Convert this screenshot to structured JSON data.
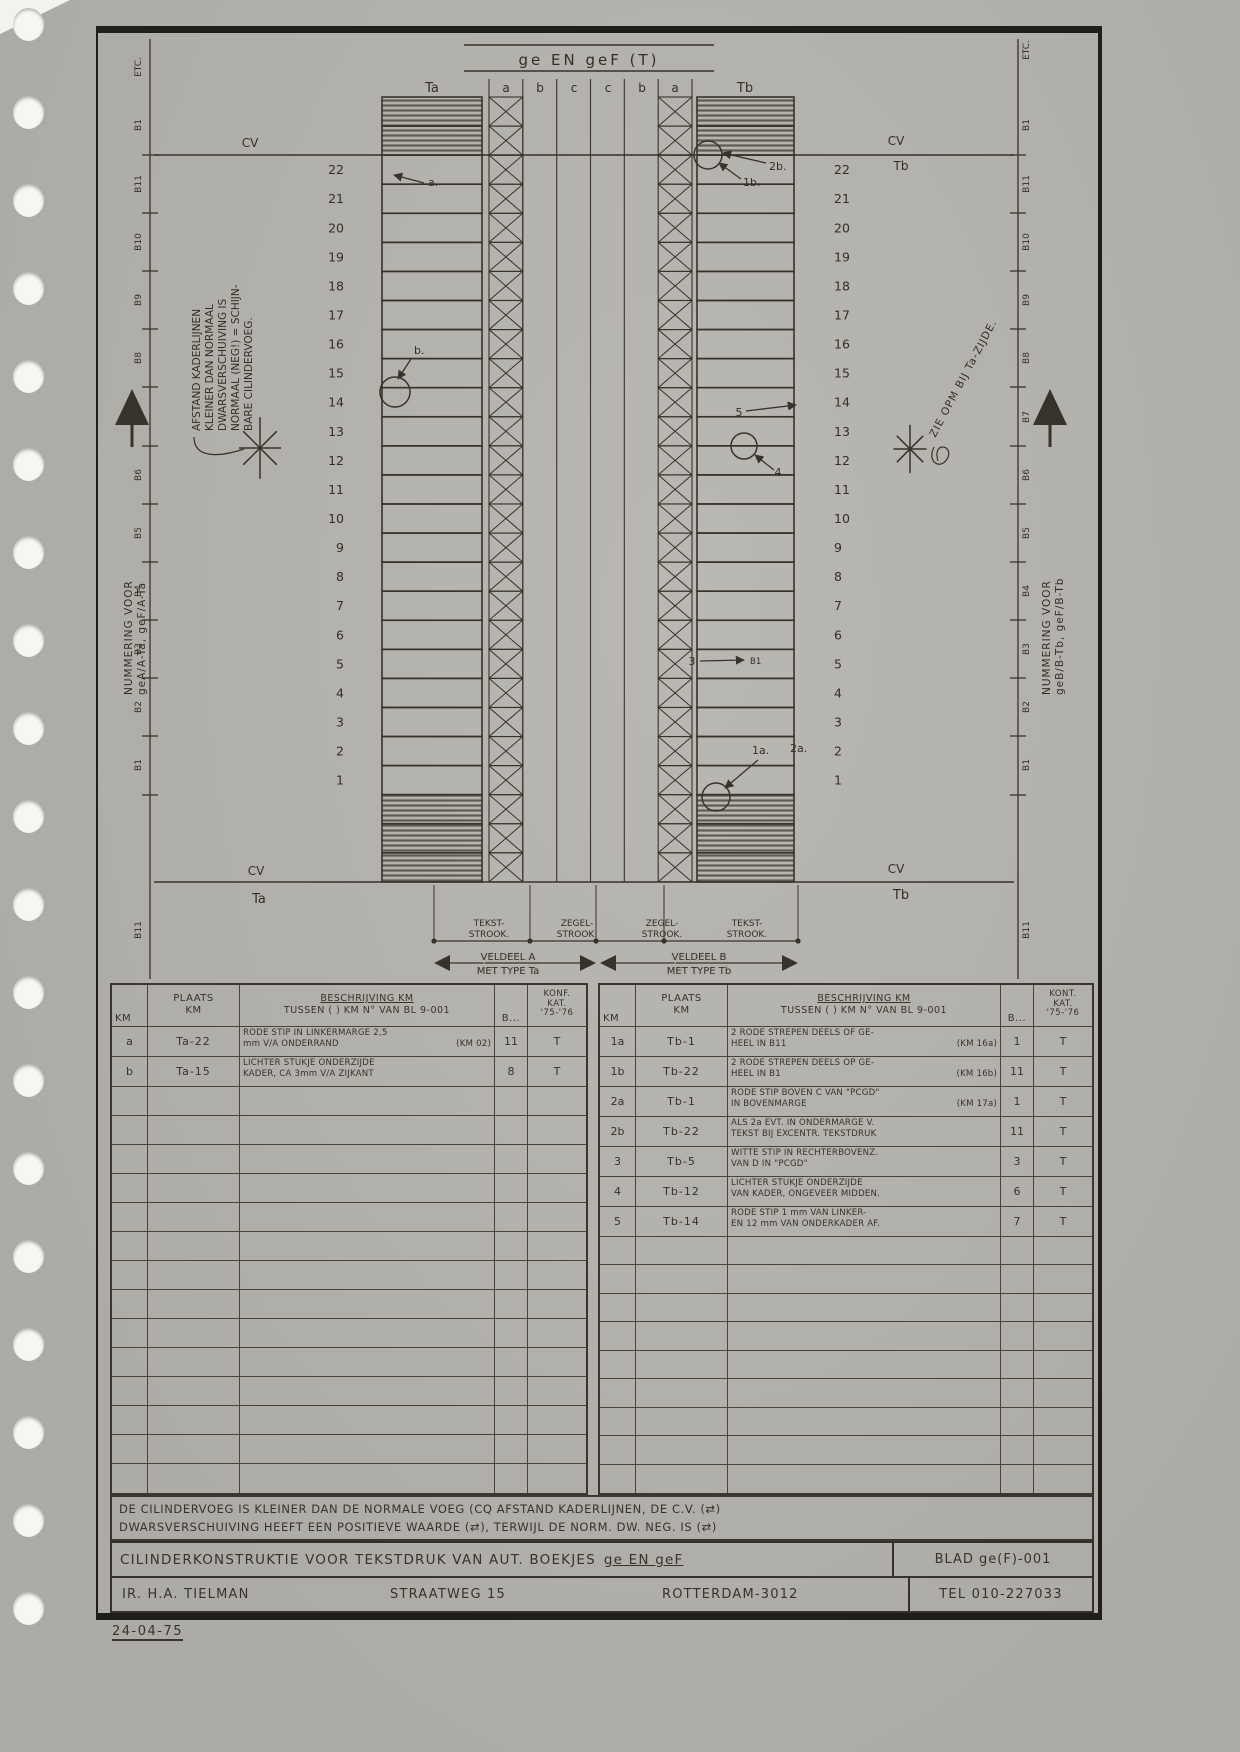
{
  "diagram": {
    "title": "ge EN geF (T)",
    "column_headers": [
      "Ta",
      "a",
      "b",
      "c",
      "c",
      "b",
      "a",
      "Tb"
    ],
    "row_numbers": [
      "22",
      "21",
      "20",
      "19",
      "18",
      "17",
      "16",
      "15",
      "14",
      "13",
      "12",
      "11",
      "10",
      "9",
      "8",
      "7",
      "6",
      "5",
      "4",
      "3",
      "2",
      "1"
    ],
    "left_ruler": [
      "ETC.",
      "B1",
      "B11",
      "B10",
      "B9",
      "B8",
      "B7",
      "B6",
      "B5",
      "B4",
      "B3",
      "B2",
      "B1",
      "B11"
    ],
    "right_ruler": [
      "ETC.",
      "B1",
      "B11",
      "B10",
      "B9",
      "B8",
      "B7",
      "B6",
      "B5",
      "B4",
      "B3",
      "B2",
      "B1",
      "B11"
    ],
    "cv_label": "CV",
    "ta_label": "Ta",
    "tb_label": "Tb",
    "left_note_lines": [
      "AFSTAND KADERLIJNEN",
      "KLEINER DAN NORMAAL",
      "DWARSVERSCHUIVING IS",
      "NORMAAL (NEG!) = SCHIJN-",
      "BARE CILINDERVOEG."
    ],
    "left_numbering_lines": [
      "NUMMERING VOOR",
      "geA/A-Ta, geF/A-Ta"
    ],
    "right_numbering_lines": [
      "NUMMERING VOOR",
      "geB/B-Tb, geF/B-Tb"
    ],
    "right_note": "ZIE OPM BIJ Ta-ZIJDE.",
    "annotations": {
      "a": "a.",
      "b": "b.",
      "b1": "1b.",
      "b2": "2b.",
      "n5": "5",
      "n4": "4",
      "n3": "3",
      "t3": "B1",
      "a1": "1a.",
      "a2": "2a."
    },
    "strip_labels": [
      [
        "TEKST-",
        "STROOK."
      ],
      [
        "ZEGEL-",
        "STROOK."
      ],
      [
        "ZEGEL-",
        "STROOK."
      ],
      [
        "TEKST-",
        "STROOK."
      ]
    ],
    "veldeel_a": [
      "VELDEEL A",
      "MET TYPE Ta"
    ],
    "veldeel_b": [
      "VELDEEL B",
      "MET TYPE Tb"
    ]
  },
  "tables": {
    "left": {
      "headers": {
        "km": "KM",
        "plaats": "PLAATS KM",
        "besch1": "BESCHRIJVING KM",
        "besch2": "TUSSEN ( ) KM N° VAN BL 9-001",
        "b": "B...",
        "kat": "KONF. KAT. '75-'76"
      },
      "rows": [
        {
          "km": "a",
          "plaats": "Ta-22",
          "l1": "RODE STIP IN LINKERMARGE 2,5",
          "l2": "mm V/A ONDERRAND",
          "ref": "(KM 02)",
          "b": "11",
          "kat": "T"
        },
        {
          "km": "b",
          "plaats": "Ta-15",
          "l1": "LICHTER STUKJE ONDERZIJDE",
          "l2": "KADER, CA 3mm V/A ZIJKANT",
          "ref": "",
          "b": "8",
          "kat": "T"
        }
      ],
      "empty_rows": 14
    },
    "right": {
      "headers": {
        "km": "KM",
        "plaats": "PLAATS KM",
        "besch1": "BESCHRIJVING KM",
        "besch2": "TUSSEN ( ) KM N° VAN BL 9-001",
        "b": "B...",
        "kat": "KONT. KAT. '75-'76"
      },
      "rows": [
        {
          "km": "1a",
          "plaats": "Tb-1",
          "l1": "2 RODE STREPEN DEELS OF GE-",
          "l2": "HEEL IN B11",
          "ref": "(KM 16a)",
          "b": "1",
          "kat": "T"
        },
        {
          "km": "1b",
          "plaats": "Tb-22",
          "l1": "2 RODE STREPEN DEELS OP GE-",
          "l2": "HEEL IN B1",
          "ref": "(KM 16b)",
          "b": "11",
          "kat": "T"
        },
        {
          "km": "2a",
          "plaats": "Tb-1",
          "l1": "RODE STIP BOVEN C VAN \"PCGD\"",
          "l2": "IN BOVENMARGE",
          "ref": "(KM 17a)",
          "b": "1",
          "kat": "T"
        },
        {
          "km": "2b",
          "plaats": "Tb-22",
          "l1": "ALS 2a EVT. IN ONDERMARGE V.",
          "l2": "TEKST BIJ EXCENTR. TEKSTDRUK",
          "ref": "",
          "b": "11",
          "kat": "T"
        },
        {
          "km": "3",
          "plaats": "Tb-5",
          "l1": "WITTE STIP IN RECHTERBOVENZ.",
          "l2": "VAN D IN \"PCGD\"",
          "ref": "",
          "b": "3",
          "kat": "T"
        },
        {
          "km": "4",
          "plaats": "Tb-12",
          "l1": "LICHTER STUKJE ONDERZIJDE",
          "l2": "VAN KADER, ONGEVEER MIDDEN.",
          "ref": "",
          "b": "6",
          "kat": "T"
        },
        {
          "km": "5",
          "plaats": "Tb-14",
          "l1": "RODE STIP 1 mm VAN LINKER-",
          "l2": "EN 12 mm VAN ONDERKADER AF.",
          "ref": "",
          "b": "7",
          "kat": "T"
        }
      ],
      "empty_rows": 9
    }
  },
  "footer": {
    "note_line1": "DE CILINDERVOEG IS KLEINER DAN DE NORMALE VOEG (CQ AFSTAND KADERLIJNEN, DE C.V. (⇄)",
    "note_line2": "DWARSVERSCHUIVING HEEFT EEN POSITIEVE WAARDE (⇄), TERWIJL DE NORM. DW. NEG. IS (⇄)",
    "title_main": "CILINDERKONSTRUKTIE VOOR TEKSTDRUK VAN AUT. BOEKJES",
    "title_em": "ge EN geF",
    "blad": "BLAD ge(F)-001",
    "author": "IR. H.A. TIELMAN",
    "street": "STRAATWEG 15",
    "city": "ROTTERDAM-3012",
    "tel": "TEL 010-227033",
    "date": "24-04-75"
  }
}
